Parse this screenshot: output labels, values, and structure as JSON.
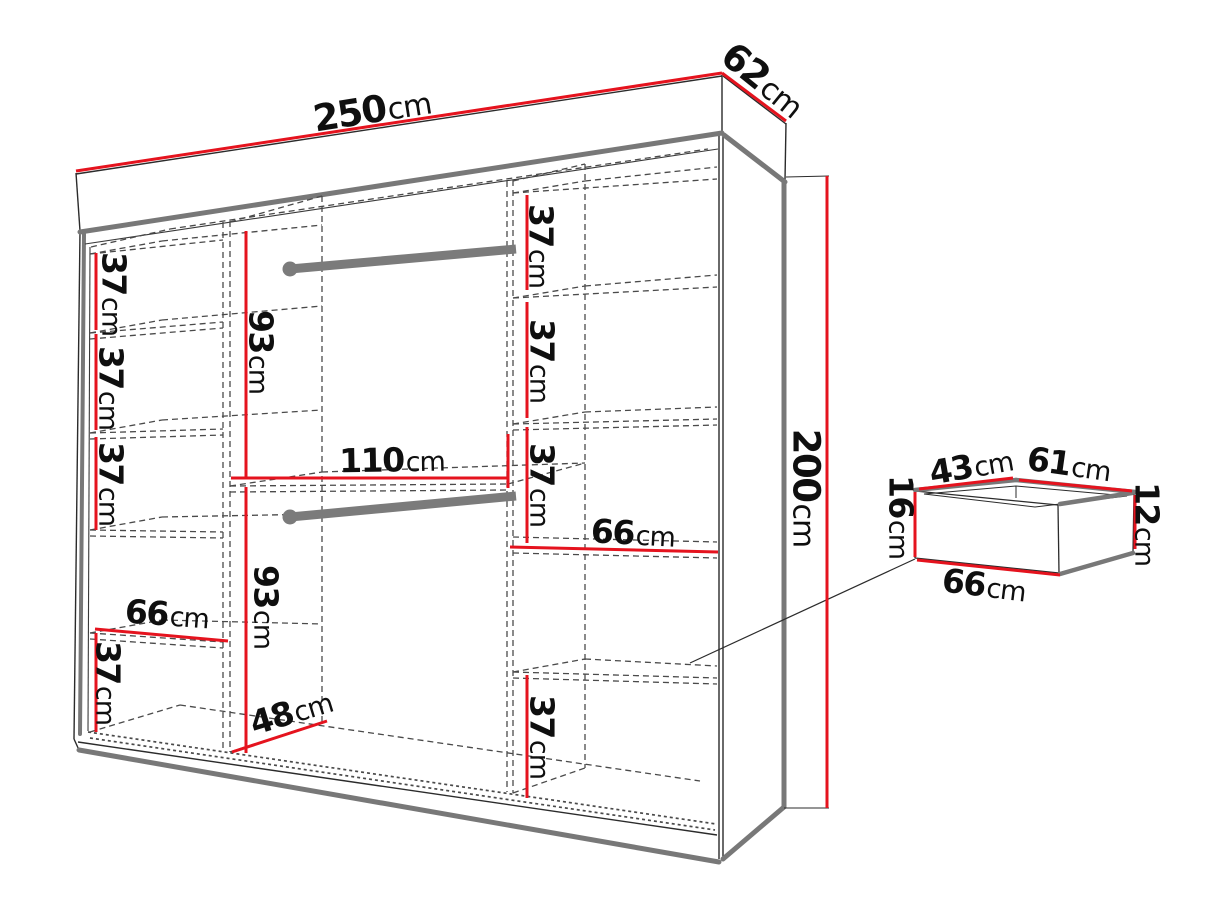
{
  "diagram": {
    "kind": "furniture-dimension-diagram",
    "subject": "wardrobe with shelves, two hanging rails and drawer detail",
    "colors": {
      "dimension_red": "#e5131e",
      "outline_black": "#2b2b2b",
      "frame_gray": "#787878",
      "dashed_gray": "#4a4a4a",
      "text": "#0f0f0f",
      "background": "#ffffff"
    },
    "overall_dimensions": {
      "width": {
        "value": "250",
        "unit": "cm"
      },
      "depth": {
        "value": "62",
        "unit": "cm"
      },
      "height": {
        "value": "200",
        "unit": "cm"
      }
    },
    "labels": [
      {
        "id": "wardrobe-width",
        "value": "250",
        "unit": "cm",
        "x": 372,
        "y": 110,
        "rot": -9,
        "size": "big"
      },
      {
        "id": "wardrobe-depth",
        "value": "62",
        "unit": "cm",
        "x": 763,
        "y": 80,
        "rot": 39,
        "size": "big"
      },
      {
        "id": "wardrobe-height",
        "value": "200",
        "unit": "cm",
        "x": 806,
        "y": 488,
        "rot": 90,
        "size": "big"
      },
      {
        "id": "left-shelf-1",
        "value": "37",
        "unit": "cm",
        "x": 114,
        "y": 294,
        "rot": 90,
        "size": "std"
      },
      {
        "id": "left-shelf-2",
        "value": "37",
        "unit": "cm",
        "x": 111,
        "y": 388,
        "rot": 90,
        "size": "std"
      },
      {
        "id": "left-shelf-3",
        "value": "37",
        "unit": "cm",
        "x": 111,
        "y": 484,
        "rot": 90,
        "size": "std"
      },
      {
        "id": "left-shelf-width",
        "value": "66",
        "unit": "cm",
        "x": 167,
        "y": 614,
        "rot": 4,
        "size": "std"
      },
      {
        "id": "left-shelf-4",
        "value": "37",
        "unit": "cm",
        "x": 108,
        "y": 683,
        "rot": 90,
        "size": "std"
      },
      {
        "id": "upper-hanging-height",
        "value": "93",
        "unit": "cm",
        "x": 261,
        "y": 352,
        "rot": 90,
        "size": "std"
      },
      {
        "id": "lower-hanging-height",
        "value": "93",
        "unit": "cm",
        "x": 266,
        "y": 607,
        "rot": 90,
        "size": "std"
      },
      {
        "id": "middle-section-width",
        "value": "110",
        "unit": "cm",
        "x": 392,
        "y": 460,
        "rot": -1,
        "size": "std"
      },
      {
        "id": "floor-depth",
        "value": "48",
        "unit": "cm",
        "x": 291,
        "y": 712,
        "rot": -17,
        "size": "std"
      },
      {
        "id": "right-shelf-1",
        "value": "37",
        "unit": "cm",
        "x": 541,
        "y": 246,
        "rot": 90,
        "size": "std"
      },
      {
        "id": "right-shelf-2",
        "value": "37",
        "unit": "cm",
        "x": 542,
        "y": 361,
        "rot": 90,
        "size": "std"
      },
      {
        "id": "right-shelf-3",
        "value": "37",
        "unit": "cm",
        "x": 542,
        "y": 485,
        "rot": 90,
        "size": "std"
      },
      {
        "id": "right-shelf-width",
        "value": "66",
        "unit": "cm",
        "x": 633,
        "y": 533,
        "rot": 3,
        "size": "std"
      },
      {
        "id": "right-shelf-4",
        "value": "37",
        "unit": "cm",
        "x": 542,
        "y": 737,
        "rot": 90,
        "size": "std"
      },
      {
        "id": "drawer-top-depth",
        "value": "43",
        "unit": "cm",
        "x": 971,
        "y": 466,
        "rot": -10,
        "size": "std"
      },
      {
        "id": "drawer-top-width",
        "value": "61",
        "unit": "cm",
        "x": 1069,
        "y": 464,
        "rot": 8,
        "size": "std"
      },
      {
        "id": "drawer-front-height",
        "value": "16",
        "unit": "cm",
        "x": 901,
        "y": 517,
        "rot": 90,
        "size": "std"
      },
      {
        "id": "drawer-back-height",
        "value": "12",
        "unit": "cm",
        "x": 1147,
        "y": 524,
        "rot": 90,
        "size": "std"
      },
      {
        "id": "drawer-width",
        "value": "66",
        "unit": "cm",
        "x": 984,
        "y": 585,
        "rot": 7,
        "size": "std"
      }
    ]
  }
}
